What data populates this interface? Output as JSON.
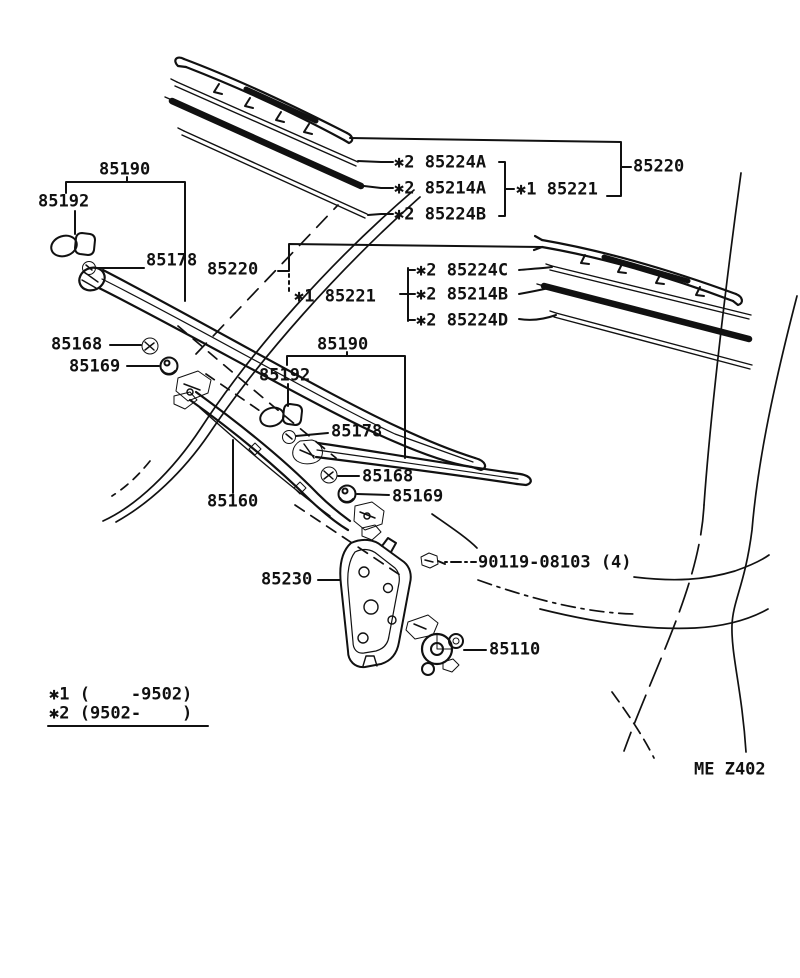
{
  "diagram": {
    "title": "Windshield wiper parts diagram",
    "code": "ME Z402",
    "ink_color": "#111111",
    "paper_color": "#ffffff"
  },
  "labels": [
    {
      "name": "part-label-85224a",
      "text": "✱2 85224A",
      "x": 394,
      "y": 163
    },
    {
      "name": "part-label-85214a",
      "text": "✱2 85214A",
      "x": 394,
      "y": 189
    },
    {
      "name": "part-label-85224b",
      "text": "✱2 85224B",
      "x": 394,
      "y": 215
    },
    {
      "name": "part-label-85221-a",
      "text": "✱1 85221",
      "x": 516,
      "y": 190
    },
    {
      "name": "part-label-85220-a",
      "text": "85220",
      "x": 633,
      "y": 167
    },
    {
      "name": "part-label-85190-a",
      "text": "85190",
      "x": 99,
      "y": 170
    },
    {
      "name": "part-label-85192-a",
      "text": "85192",
      "x": 38,
      "y": 202
    },
    {
      "name": "part-label-85178-a",
      "text": "85178",
      "x": 146,
      "y": 261
    },
    {
      "name": "part-label-85220-b",
      "text": "85220",
      "x": 207,
      "y": 270
    },
    {
      "name": "part-label-85221-b",
      "text": "✱1 85221",
      "x": 294,
      "y": 297
    },
    {
      "name": "part-label-85224c",
      "text": "✱2 85224C",
      "x": 416,
      "y": 271
    },
    {
      "name": "part-label-85214b",
      "text": "✱2 85214B",
      "x": 416,
      "y": 295
    },
    {
      "name": "part-label-85224d",
      "text": "✱2 85224D",
      "x": 416,
      "y": 321
    },
    {
      "name": "part-label-85168-a",
      "text": "85168",
      "x": 51,
      "y": 345
    },
    {
      "name": "part-label-85169-a",
      "text": "85169",
      "x": 69,
      "y": 367
    },
    {
      "name": "part-label-85190-b",
      "text": "85190",
      "x": 317,
      "y": 345
    },
    {
      "name": "part-label-85192-b",
      "text": "85192",
      "x": 259,
      "y": 376
    },
    {
      "name": "part-label-85178-b",
      "text": "85178",
      "x": 331,
      "y": 432
    },
    {
      "name": "part-label-85168-b",
      "text": "85168",
      "x": 362,
      "y": 477
    },
    {
      "name": "part-label-85169-b",
      "text": "85169",
      "x": 392,
      "y": 497
    },
    {
      "name": "part-label-85160",
      "text": "85160",
      "x": 207,
      "y": 502
    },
    {
      "name": "part-label-85230",
      "text": "85230",
      "x": 261,
      "y": 580
    },
    {
      "name": "part-label-90119",
      "text": "90119-08103 (4)",
      "x": 478,
      "y": 563
    },
    {
      "name": "part-label-85110",
      "text": "85110",
      "x": 489,
      "y": 650
    },
    {
      "name": "legend-note-1",
      "text": "✱1 (    -9502)",
      "x": 49,
      "y": 695
    },
    {
      "name": "legend-note-2",
      "text": "✱2 (9502-    )",
      "x": 49,
      "y": 714
    },
    {
      "name": "diagram-code",
      "text": "ME Z402",
      "x": 694,
      "y": 770
    }
  ]
}
